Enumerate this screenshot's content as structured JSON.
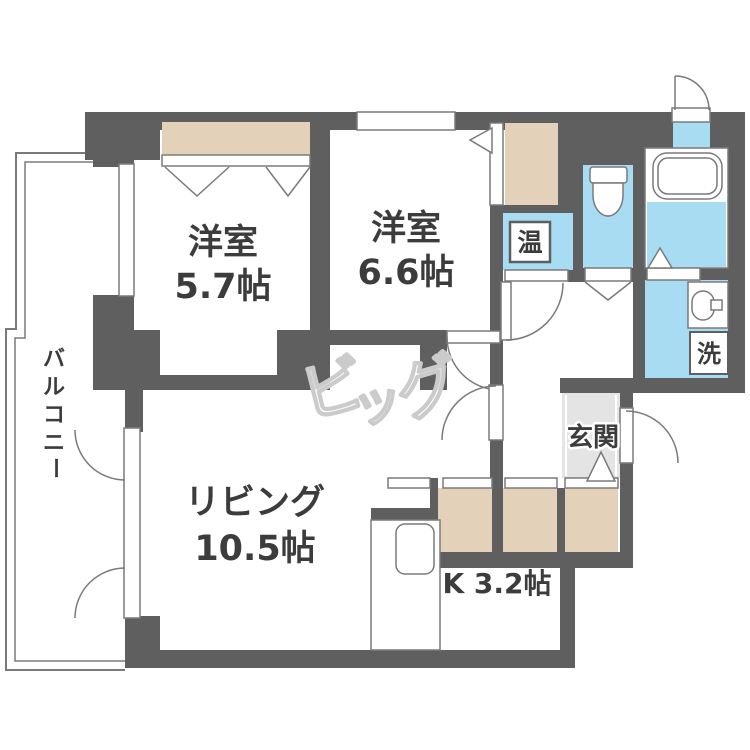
{
  "plan": {
    "rooms": {
      "bedroom1": {
        "label": "洋室",
        "size": "5.7帖"
      },
      "bedroom2": {
        "label": "洋室",
        "size": "6.6帖"
      },
      "living": {
        "label": "リビング",
        "size": "10.5帖"
      },
      "kitchen": {
        "label": "K 3.2帖"
      },
      "genkan": {
        "label": "玄関"
      },
      "balcony": {
        "chars": [
          "バ",
          "ル",
          "コ",
          "ニ",
          "ー"
        ]
      }
    },
    "fixtures": {
      "water_heater": "温",
      "laundry": "洗"
    },
    "watermark": {
      "chars": [
        "ビ",
        "ッ",
        "グ"
      ]
    },
    "colors": {
      "wall": "#5f5f5f",
      "line": "#7a7a7a",
      "blue": "#a8dcf2",
      "beige": "#e3d1ba",
      "genkan_gray": "#e4e4e4",
      "text": "#3c3c3c",
      "watermark": "#cbcbcb"
    }
  }
}
